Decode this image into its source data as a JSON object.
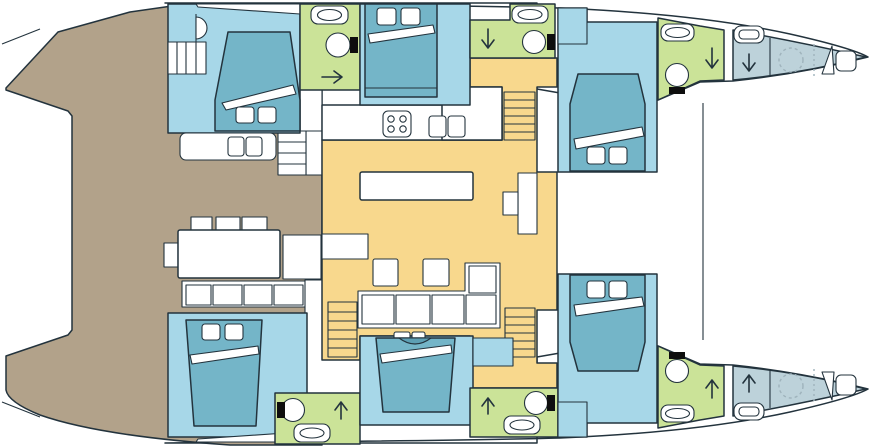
{
  "diagram": {
    "type": "catamaran-deck-plan",
    "orientation": "bow-right",
    "areas": [
      "aft-cockpit",
      "cockpit-dining",
      "saloon",
      "galley",
      "nav-desk",
      "starboard-aft-cabin",
      "starboard-aft-bathroom",
      "starboard-mid-cabin",
      "starboard-mid-bathroom",
      "starboard-fwd-cabin",
      "starboard-fwd-bathroom",
      "starboard-forepeak",
      "port-aft-cabin",
      "port-aft-bathroom",
      "port-mid-cabin",
      "port-mid-bathroom",
      "port-fwd-cabin",
      "port-fwd-bathroom",
      "port-forepeak"
    ],
    "counts": {
      "double_beds": 6,
      "bathrooms": 6,
      "stairways": 3,
      "forepeaks": 2
    }
  },
  "palette": {
    "cockpit": "#b2a28a",
    "cabin": "#a7d7e8",
    "bed": "#74b5c8",
    "bed_dark": "#5d9fb4",
    "bathroom": "#cbe398",
    "saloon": "#f8d88d",
    "crew": "#bdd2da",
    "outline": "#23333d",
    "white": "#ffffff",
    "fixture": "#0e0e0e",
    "dashed": "#9fb3bc"
  }
}
